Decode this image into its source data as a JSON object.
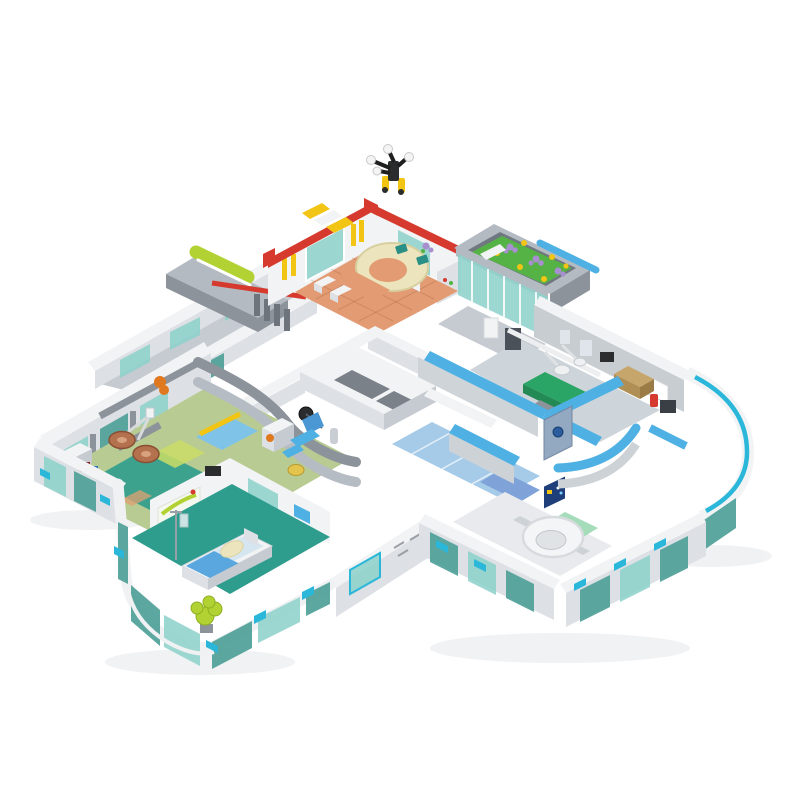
{
  "meta": {
    "type": "product-photo",
    "subject": "Brick-built modular hospital playset, aerial isometric cutaway view on white background",
    "background": "#ffffff"
  },
  "colors": {
    "bg": "#ffffff",
    "wall_white": "#f2f3f5",
    "wall_shade": "#dde0e4",
    "wall_dark": "#c6cbd1",
    "gray_cap": "#8d939b",
    "gray_light": "#b4bac1",
    "red": "#d63a2e",
    "orange_floor": "#e29b72",
    "cream": "#ece4bd",
    "glass_teal": "#8ed1cb",
    "glass_deep": "#4e9f98",
    "cyan": "#2ab7d9",
    "azure": "#4fb1e3",
    "blue_floor": "#a6cbe9",
    "periwinkle": "#7fa3d8",
    "sage": "#b8cb92",
    "teal_floor": "#2f9d8e",
    "mint": "#a5dcba",
    "green_table": "#2aa565",
    "lime": "#b2d233",
    "yellow": "#f2c414",
    "copper": "#b4714e",
    "dark": "#2a2c2e",
    "tan": "#c6a66b",
    "screen_blue": "#1e3f7a",
    "purple": "#a88fd0",
    "leaf": "#55b244",
    "shadow": "#e2e5e8"
  },
  "modules": {
    "drone_figure": {
      "label": "black camera-drone minifigure on roof edge",
      "accents": [
        "white-lamps",
        "yellow-feet"
      ]
    },
    "entrance_lobby": {
      "label": "reception lobby",
      "trim": "red",
      "floor": "orange-tile",
      "desk": "cream curved reception counter",
      "details": [
        "yellow-ladder-strips",
        "glass-door",
        "hazard-canopy"
      ]
    },
    "rooftop_garden": {
      "label": "rooftop flower garden over glazed entrance",
      "flowers": [
        "purple",
        "yellow"
      ],
      "railing": "azure"
    },
    "elevator_core": {
      "label": "central corridor cross with twin elevator shafts"
    },
    "left_wing": {
      "label": "examination wing",
      "rooms": [
        "operating room with copper lamp dishes",
        "dental room with blue chair and yellow stool"
      ],
      "floor": "sage-green with teal and azure patches"
    },
    "right_wing": {
      "label": "surgery wing",
      "wall_caps": "azure",
      "rooms": [
        "operating room with green table and surgical light",
        "CT-scanner room with mint bed and monitor"
      ]
    },
    "patient_room": {
      "label": "patient room",
      "bed": "white frame, azure blanket, cream pillow",
      "extras": [
        "IV-stand",
        "lime plant behind rounded glass corner"
      ]
    },
    "facade": {
      "label": "curtain wall",
      "glass": "teal",
      "clips": "cyan",
      "corners": "rounded white with cyan stripe"
    }
  }
}
